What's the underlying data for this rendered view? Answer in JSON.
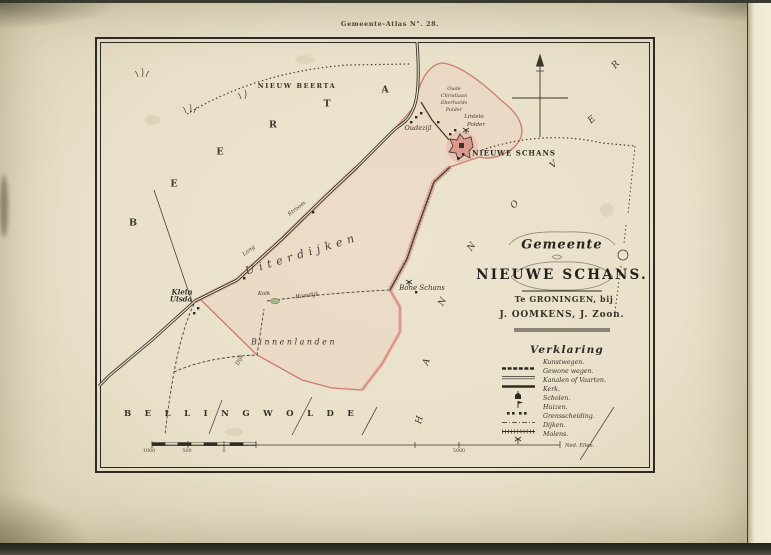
{
  "page": {
    "plate_label": "Gemeente-Atlas N°. 28.",
    "paper_color": "#e9e1cb",
    "ink_color": "#2c2a22",
    "boundary_pink": "#cf7a70",
    "pond_green": "#a9b88c"
  },
  "cartouche": {
    "gemeente": "Gemeente",
    "title": "NIEUWE SCHANS.",
    "publisher_line1": "Te GRONINGEN, bij",
    "publisher_line2": "J. OOMKENS, J. Zoon."
  },
  "legend": {
    "title": "Verklaring",
    "items": [
      {
        "icon": "kunstweg-line-symbol",
        "label": "Kunstwegen."
      },
      {
        "icon": "gewone-weg-line-symbol",
        "label": "Gewone wegen."
      },
      {
        "icon": "kanaal-line-symbol",
        "label": "Kanalen of Vaarten."
      },
      {
        "icon": "kerk-symbol",
        "label": "Kerk."
      },
      {
        "icon": "school-symbol",
        "label": "Scholen."
      },
      {
        "icon": "huizen-symbol",
        "label": "Huizen."
      },
      {
        "icon": "grens-line-symbol",
        "label": "Grensscheiding."
      },
      {
        "icon": "dijk-line-symbol",
        "label": "Dijken."
      },
      {
        "icon": "molen-symbol",
        "label": "Molens."
      }
    ]
  },
  "map": {
    "regions": {
      "nieuw_beerta": "NIEUW BEERTA",
      "beerta": "BEERTA",
      "hannover": "HANNOVER",
      "bellingwolde": "BELLINGWOLDE"
    },
    "areas": {
      "uiterdijken": "Uiterdijken",
      "binnenlanden": "Binnenlanden"
    },
    "places": {
      "nieuwe_schans": "NIEUWE SCHANS",
      "oudezijl": "Oudezijl",
      "klein_ulsda_line1": "Klein",
      "klein_ulsda_line2": "Ulsda",
      "bone_schans": "Bone Schans",
      "kolk": "Kolk",
      "polder_line1": "Oude",
      "polder_line2": "Christiaan",
      "polder_line3": "Eberhards",
      "polder_line4": "Polder",
      "lintelo_line1": "Lintelo",
      "lintelo_line2": "Polder"
    },
    "road_labels": {
      "stroom": "Stroom",
      "lang": "Lang",
      "hamdijk": "Hamdijk",
      "dijk": "Dijk"
    },
    "scale": {
      "labels": [
        "1000",
        "500",
        "0",
        "5000"
      ],
      "unit": "Ned. Ellen."
    }
  }
}
